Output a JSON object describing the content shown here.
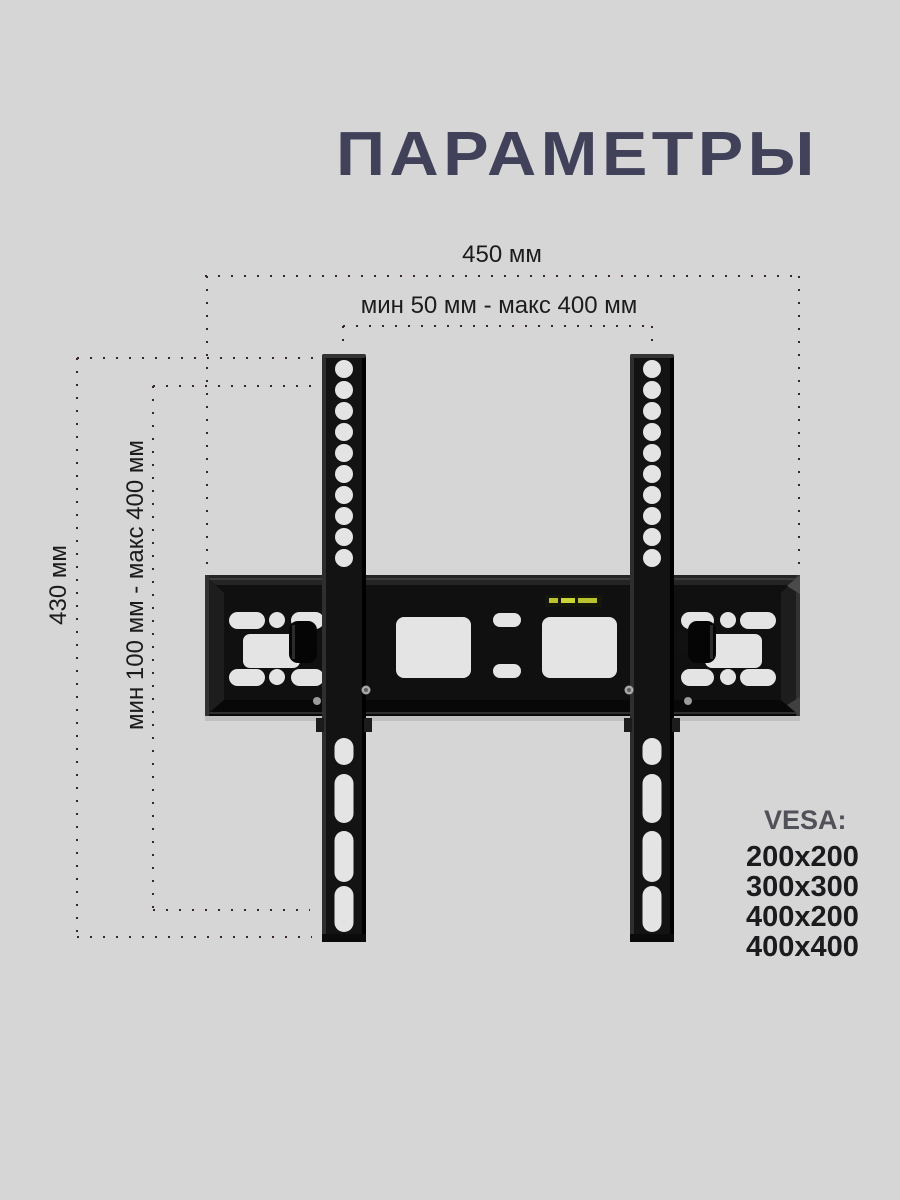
{
  "title": "ПАРАМЕТРЫ",
  "annotations": {
    "width_total": "450 мм",
    "width_range": "мин 50 мм - макс 400 мм",
    "height_total": "430 мм",
    "height_range": "мин 100 мм - макс 400 мм"
  },
  "vesa": {
    "label": "VESA:",
    "sizes": [
      "200x200",
      "300x300",
      "400x200",
      "400x400"
    ]
  },
  "product": {
    "illustration": "black tilting TV wall-mount bracket: horizontal wall plate with two vertical VESA rails"
  },
  "colors": {
    "background": "#d6d6d6",
    "title": "#41415a",
    "dimension_dots": "#382828",
    "dimension_text": "#1c1c1c",
    "vesa_label": "#51515a",
    "vesa_sizes": "#1b1b1e",
    "bracket_black": "#101010",
    "sticker_yellow": "#c4cf35"
  }
}
